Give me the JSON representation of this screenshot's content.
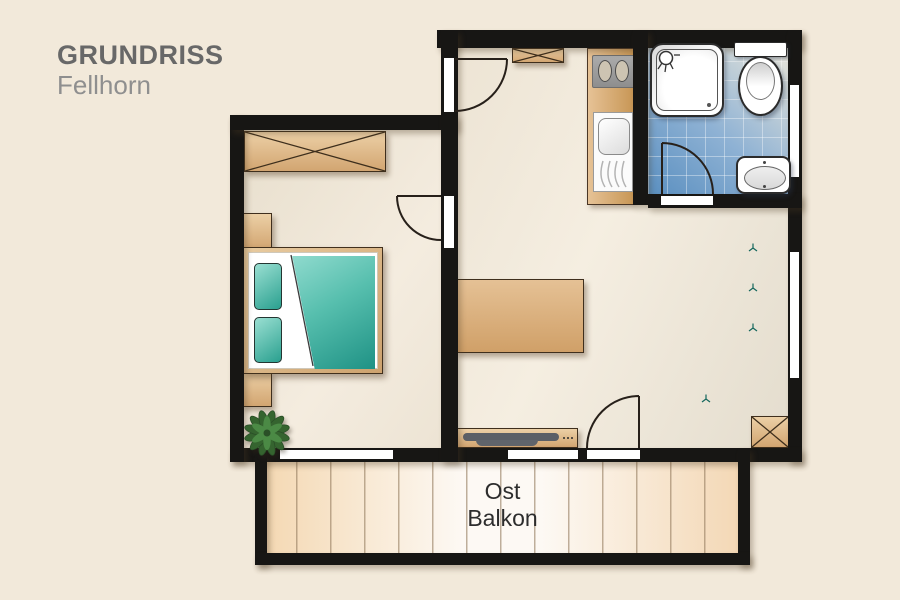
{
  "header": {
    "title": "GRUNDRISS",
    "subtitle": "Fellhorn"
  },
  "balcony": {
    "line1": "Ost",
    "line2": "Balkon"
  },
  "palette": {
    "background": "#f2e9da",
    "wall": "#171614",
    "wood": "#d9ae7c",
    "wood_light": "#ecd0a6",
    "wood_dark": "#c89756",
    "teal": "#28a292",
    "teal_light": "#8edacc",
    "teal_dark": "#1b8f81",
    "bath_tile_dark": "#5a8fc0",
    "bath_tile_light": "#e7e5da",
    "floor": "#efe7d8",
    "balcony_floor": "#f4d8b2",
    "fixture_white": "#ffffff",
    "plant_green": "#417a3e",
    "title_text": "#686868",
    "subtitle_text": "#8f8f8f",
    "label_text": "#2d2d2d"
  }
}
